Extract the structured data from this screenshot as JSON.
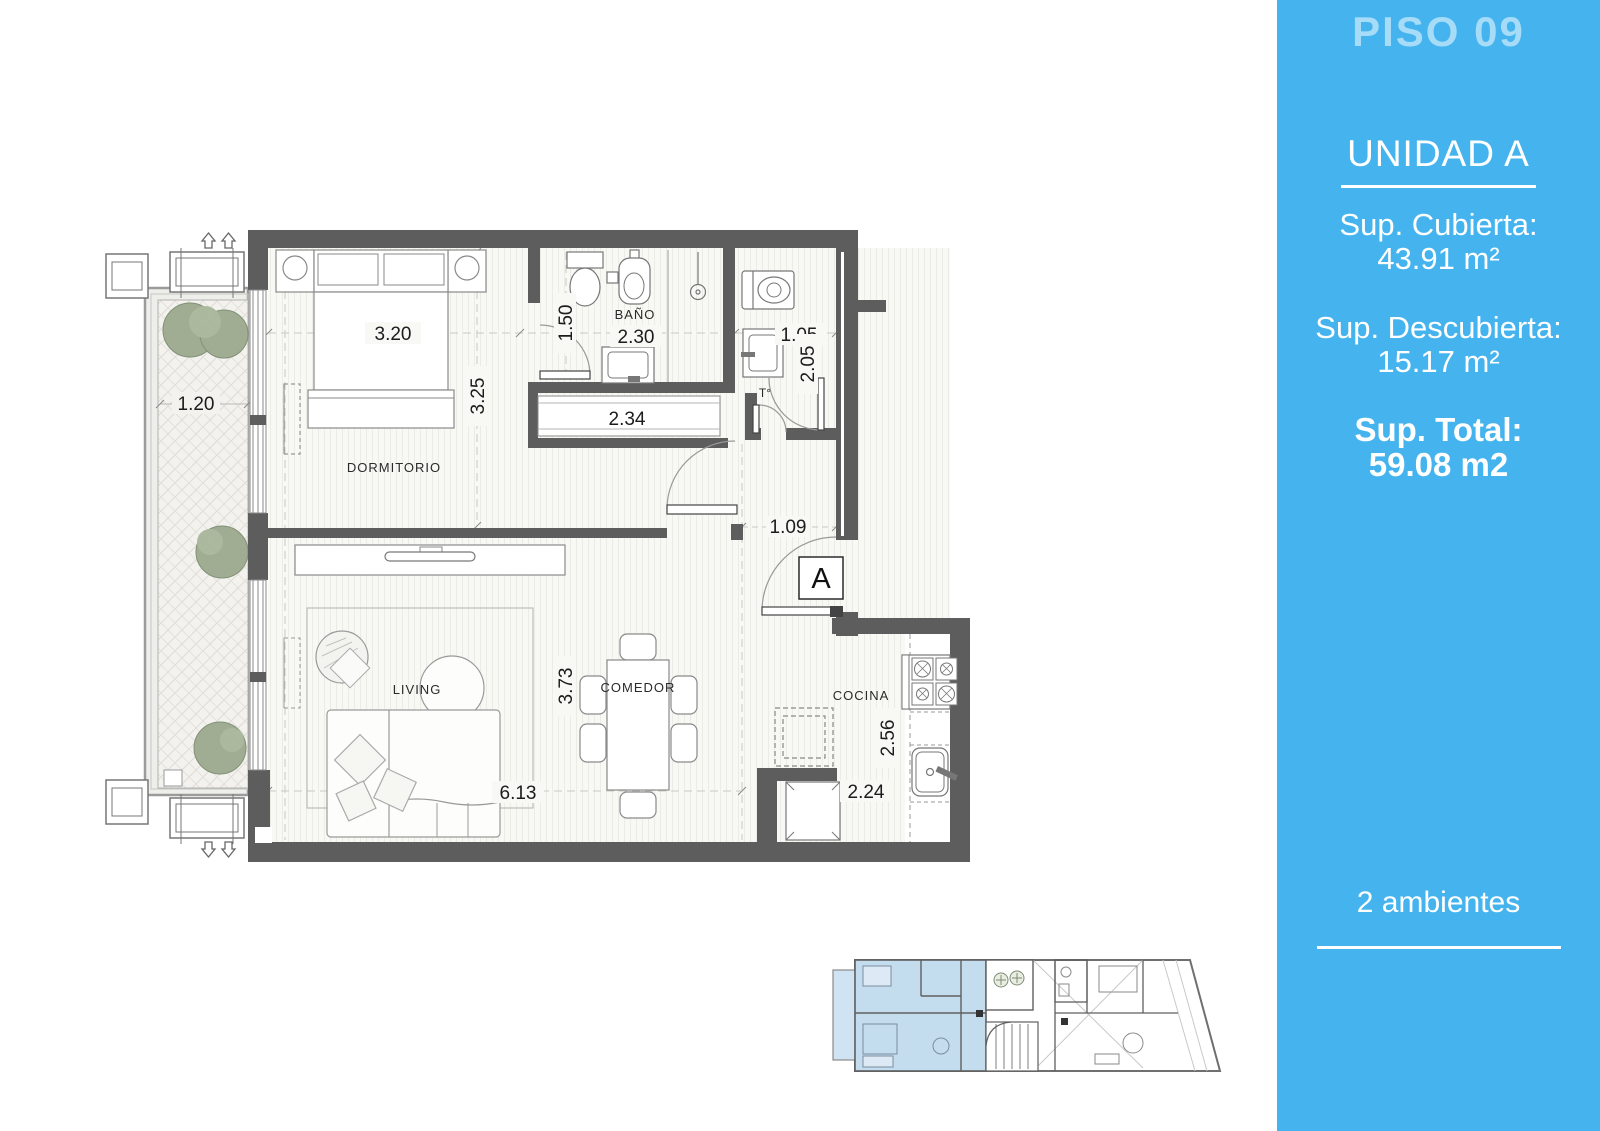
{
  "sidebar": {
    "floor_title": "PISO 09",
    "unit_title": "UNIDAD A",
    "covered_label": "Sup. Cubierta:",
    "covered_value": "43.91 m²",
    "uncovered_label": "Sup. Descubierta:",
    "uncovered_value": "15.17 m²",
    "total_label": "Sup. Total:",
    "total_value": "59.08 m2",
    "rooms_count": "2 ambientes",
    "background_color": "#45b4ee",
    "floor_title_color": "#a6dcf7"
  },
  "plan": {
    "room_labels": {
      "dormitorio": "DORMITORIO",
      "bano": "BAÑO",
      "living": "LIVING",
      "comedor": "COMEDOR",
      "cocina": "COCINA"
    },
    "dimensions": {
      "balcony_width": "1.20",
      "bedroom_width": "3.20",
      "bedroom_depth": "3.25",
      "bath_hall_width": "1.50",
      "bath_width": "2.30",
      "closet_width": "2.34",
      "laundry_width": "1.05",
      "laundry_depth": "2.05",
      "entry_width": "1.09",
      "living_width": "6.13",
      "dining_depth": "3.73",
      "kitchen_depth": "2.56",
      "kitchen_width": "2.24"
    },
    "markers": {
      "unit_marker": "A",
      "water_heater": "T°"
    },
    "wall_color": "#5d5d5d",
    "unit_highlight_color": "#c3dcee"
  }
}
